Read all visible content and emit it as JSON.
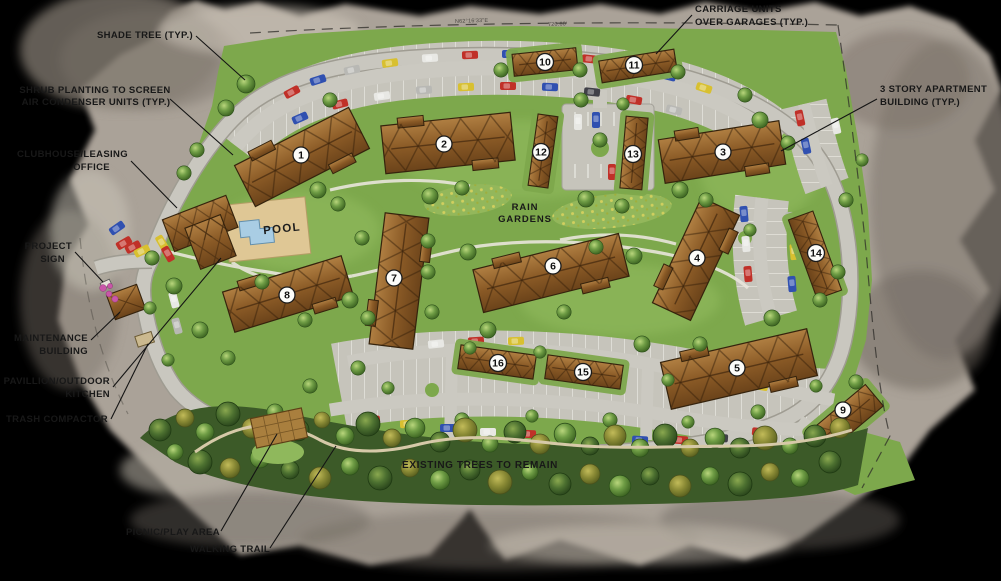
{
  "document": {
    "type": "apartment-community-site-plan"
  },
  "colors": {
    "background": "#000000",
    "paper": "#aaa298",
    "grass": "#7da84c",
    "road": "#c9c7bf",
    "building_roof": "#8a5a26",
    "pool_water": "#a9cde4",
    "pool_deck": "#dfc795",
    "forest": "#3c5a28",
    "label_text": "#181818"
  },
  "annotations": {
    "shade_tree": {
      "text": "SHADE TREE (TYP.)"
    },
    "shrub_planting": {
      "line1": "SHRUB PLANTING TO SCREEN",
      "line2": "AIR CONDENSER UNITS (TYP.)"
    },
    "clubhouse": {
      "line1": "CLUBHOUSE/LEASING",
      "line2": "OFFICE"
    },
    "project_sign": {
      "line1": "PROJECT",
      "line2": "SIGN"
    },
    "maintenance_building": {
      "line1": "MAINTENANCE",
      "line2": "BUILDING"
    },
    "pavillion": {
      "line1": "PAVILLION/OUTDOOR",
      "line2": "KITCHEN"
    },
    "trash_compactor": {
      "text": "TRASH COMPACTOR"
    },
    "carriage_units": {
      "line1": "CARRIAGE UNITS",
      "line2": "OVER GARAGES (TYP.)"
    },
    "three_story": {
      "line1": "3 STORY APARTMENT",
      "line2": "BUILDING (TYP.)"
    },
    "rain_gardens": {
      "line1": "RAIN",
      "line2": "GARDENS"
    },
    "pool": {
      "text": "POOL"
    },
    "existing_trees": {
      "text": "EXISTING TREES TO REMAIN"
    },
    "picnic_play": {
      "text": "PICNIC/PLAY AREA"
    },
    "walking_trail": {
      "text": "WALKING TRAIL"
    }
  },
  "survey": {
    "bearing_1": "N62°16'33\"E",
    "distance_1": "720.60'"
  },
  "buildings": [
    {
      "number": "1"
    },
    {
      "number": "2"
    },
    {
      "number": "3"
    },
    {
      "number": "4"
    },
    {
      "number": "5"
    },
    {
      "number": "6"
    },
    {
      "number": "7"
    },
    {
      "number": "8"
    },
    {
      "number": "9"
    },
    {
      "number": "10"
    },
    {
      "number": "11"
    },
    {
      "number": "12"
    },
    {
      "number": "13"
    },
    {
      "number": "14"
    },
    {
      "number": "15"
    },
    {
      "number": "16"
    }
  ]
}
